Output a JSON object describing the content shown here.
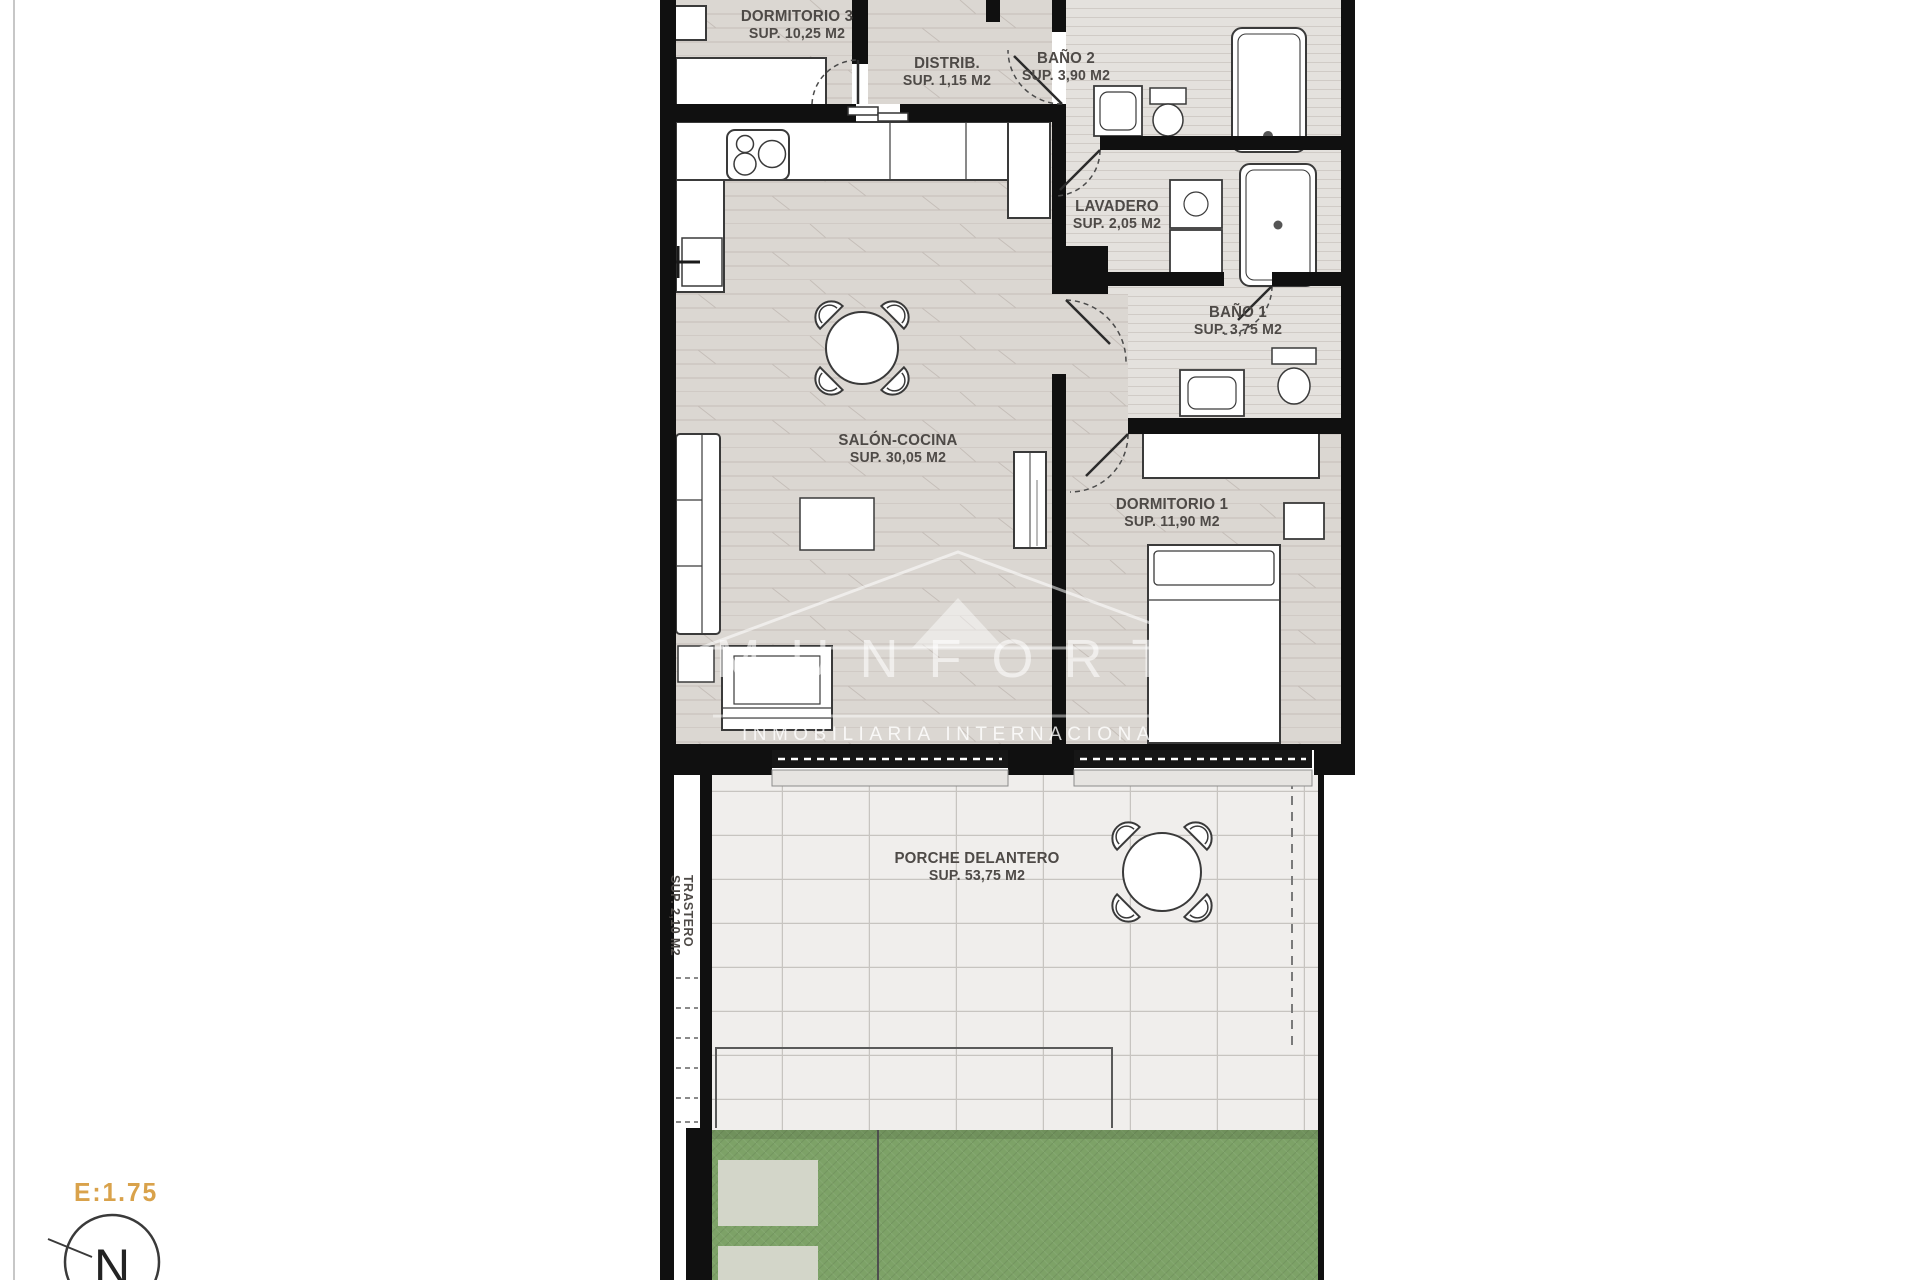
{
  "plan": {
    "rooms": [
      {
        "id": "dormitorio3",
        "name": "DORMITORIO 3",
        "area": "SUP. 10,25 M2"
      },
      {
        "id": "distribuidor",
        "name": "DISTRIB.",
        "area": "SUP. 1,15 M2"
      },
      {
        "id": "bano2",
        "name": "BAÑO 2",
        "area": "SUP. 3,90 M2"
      },
      {
        "id": "lavadero",
        "name": "LAVADERO",
        "area": "SUP. 2,05 M2"
      },
      {
        "id": "bano1",
        "name": "BAÑO 1",
        "area": "SUP. 3,75 M2"
      },
      {
        "id": "salon_cocina",
        "name": "SALÓN-COCINA",
        "area": "SUP. 30,05 M2"
      },
      {
        "id": "dormitorio1",
        "name": "DORMITORIO 1",
        "area": "SUP. 11,90 M2"
      },
      {
        "id": "porche_delantero",
        "name": "PORCHE DELANTERO",
        "area": "SUP. 53,75 M2"
      },
      {
        "id": "trastero",
        "name": "TRASTERO",
        "area": "SUP. 2,10 M2"
      }
    ],
    "watermark": {
      "brand": "MUNFORT",
      "subtitle": "INMOBILIARIA INTERNACIONAL"
    },
    "scale_label": "E:1.75",
    "north_label": "N"
  },
  "colors": {
    "wall_black": "#101010",
    "wood_floor": "#dbd7d2",
    "bath_floor": "#e4e1dd",
    "porch_tile": "#f0eeec",
    "garden_green": "#7da267",
    "stepping_stone": "#d3d6c9",
    "scale_accent": "#d9a24b",
    "label_grey": "#4e4a47",
    "watermark_white": "rgba(255,255,255,0.6)"
  }
}
